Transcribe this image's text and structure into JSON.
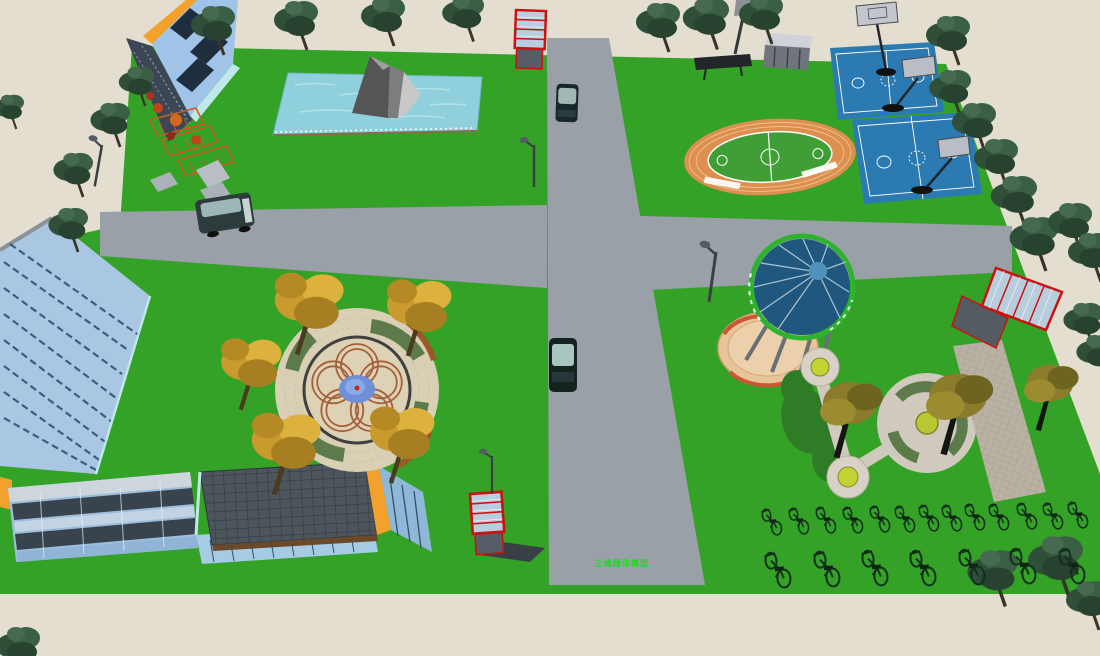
{
  "scene": {
    "type": "3d-site-plan-render",
    "title": "campus park 3D model",
    "watermark": "三维绿化模型",
    "colors": {
      "grass": "#34a227",
      "ground": "#e3decf",
      "road": "#9aa0a8",
      "water": "#8fd0dc",
      "trackOrange": "#dd8f4f",
      "fieldGreen": "#3f9e35",
      "courtBlue": "#2b7ab2",
      "domeBlue": "#1f577f",
      "domeRimGreen": "#2db32d",
      "plazaTan": "#d9cfb5",
      "petalBrown": "#a5603a",
      "plazaPondBlue": "#6f8fd8",
      "accentOrange": "#f2a22c",
      "glassBlue": "#9fc4e8",
      "facadeBlue": "#a9c6e2",
      "boardRed": "#cc1111",
      "boardGlass": "#b8cede",
      "treeDark": "#2f4f38",
      "treeYellow": "#c99a2e",
      "treeOlive": "#8a7c2a",
      "benchBrown": "#9a5a26",
      "hedgeGreen": "#5d7a4a",
      "gravelPath": "#b9b2a4",
      "gazeboBase": "#e8c49a",
      "rockGray": "#7d7d7d",
      "watermarkGreen": "#18dd18"
    },
    "inventory": {
      "roads": [
        "north-south-road",
        "east-west-road"
      ],
      "buildings": [
        "glass-tower-north",
        "slab-building-west",
        "low-building-southwest-a",
        "low-building-southwest-b"
      ],
      "water_features": [
        "rock-pond",
        "flower-plaza-fountain"
      ],
      "sports_facilities": [
        "running-track-with-field",
        "basketball-court-upper",
        "basketball-court-lower",
        "basketball-hoops",
        "grandstand",
        "scoreboard-pole"
      ],
      "landscape": [
        "flower-plaza",
        "dome-gazebo",
        "garden-circles",
        "gravel-walkway",
        "flowerbeds",
        "hedge-ring"
      ],
      "street_furniture": [
        "bulletin-board-north",
        "bulletin-board-south",
        "glass-kiosk-east",
        "street-lamps",
        "playground"
      ],
      "vehicles": {
        "cars_on_road": 2,
        "vans": 1
      },
      "bicycles": {
        "back_row_count": 13,
        "front_row_count": 7
      },
      "tree_types": [
        "dark-green",
        "autumn-yellow",
        "olive"
      ]
    }
  }
}
